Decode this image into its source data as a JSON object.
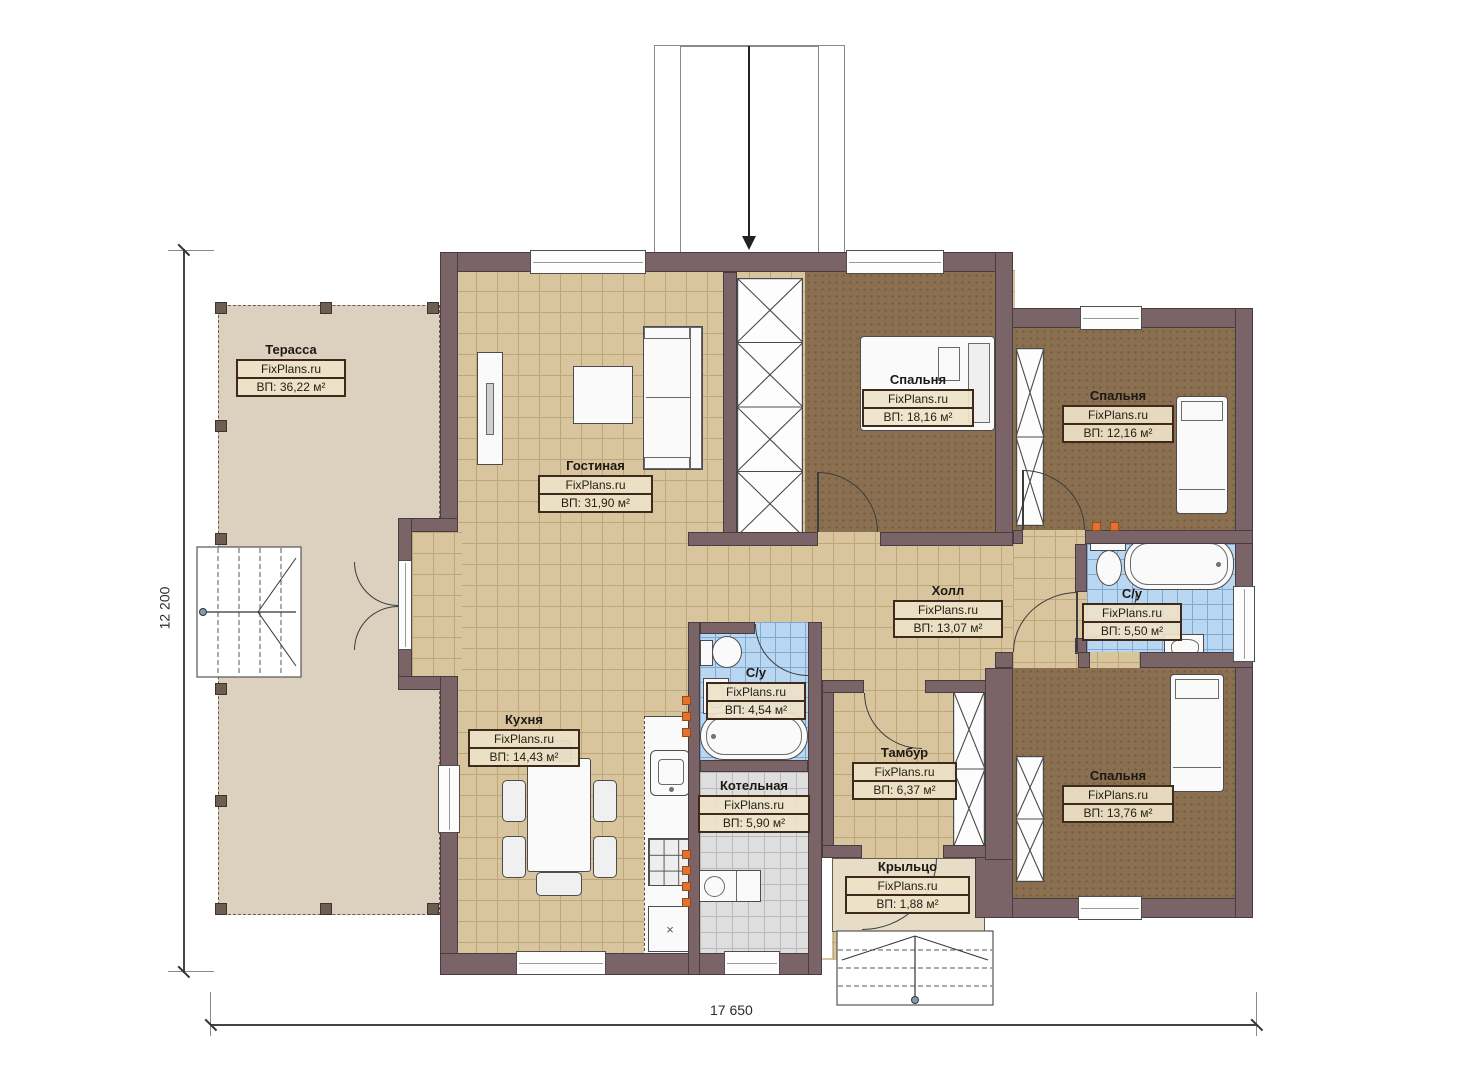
{
  "source_brand": "FixPlans.ru",
  "plan_dimensions": {
    "height_label": "12 200",
    "width_label": "17 650"
  },
  "rooms": [
    {
      "key": "terrace",
      "name": "Терасса",
      "brand": "FixPlans.ru",
      "area": "ВП: 36,22 м²"
    },
    {
      "key": "living",
      "name": "Гостиная",
      "brand": "FixPlans.ru",
      "area": "ВП: 31,90 м²"
    },
    {
      "key": "bedroom1",
      "name": "Спальня",
      "brand": "FixPlans.ru",
      "area": "ВП: 18,16 м²"
    },
    {
      "key": "bedroom2",
      "name": "Спальня",
      "brand": "FixPlans.ru",
      "area": "ВП: 12,16 м²"
    },
    {
      "key": "hall",
      "name": "Холл",
      "brand": "FixPlans.ru",
      "area": "ВП: 13,07 м²"
    },
    {
      "key": "bath1",
      "name": "С/у",
      "brand": "FixPlans.ru",
      "area": "ВП: 5,50 м²"
    },
    {
      "key": "kitchen",
      "name": "Кухня",
      "brand": "FixPlans.ru",
      "area": "ВП: 14,43 м²"
    },
    {
      "key": "bath2",
      "name": "С/у",
      "brand": "FixPlans.ru",
      "area": "ВП: 4,54 м²"
    },
    {
      "key": "vestibule",
      "name": "Тамбур",
      "brand": "FixPlans.ru",
      "area": "ВП: 6,37 м²"
    },
    {
      "key": "boiler",
      "name": "Котельная",
      "brand": "FixPlans.ru",
      "area": "ВП: 5,90 м²"
    },
    {
      "key": "bedroom3",
      "name": "Спальня",
      "brand": "FixPlans.ru",
      "area": "ВП: 13,76 м²"
    },
    {
      "key": "porch",
      "name": "Крыльцо",
      "brand": "FixPlans.ru",
      "area": "ВП: 1,88 м²"
    }
  ],
  "icons": {
    "kitchen_unit_mark": "×"
  },
  "colors": {
    "wall": "#7b6467",
    "wall_outline": "#473c40",
    "floor_tile": "#d8c59d",
    "tile_grid": "#bda77a",
    "bedroom_floor": "#8a7051",
    "bath_tile": "#b9d7f1",
    "bath_grid": "#7fa9d2",
    "boiler_tile": "#dedede",
    "terrace_floor": "#dcd1bf",
    "porch_floor": "#e7ddc7",
    "label_border": "#3e2a1d",
    "label_bg": "#eee2c8",
    "heating_marker": "#e0742f"
  }
}
